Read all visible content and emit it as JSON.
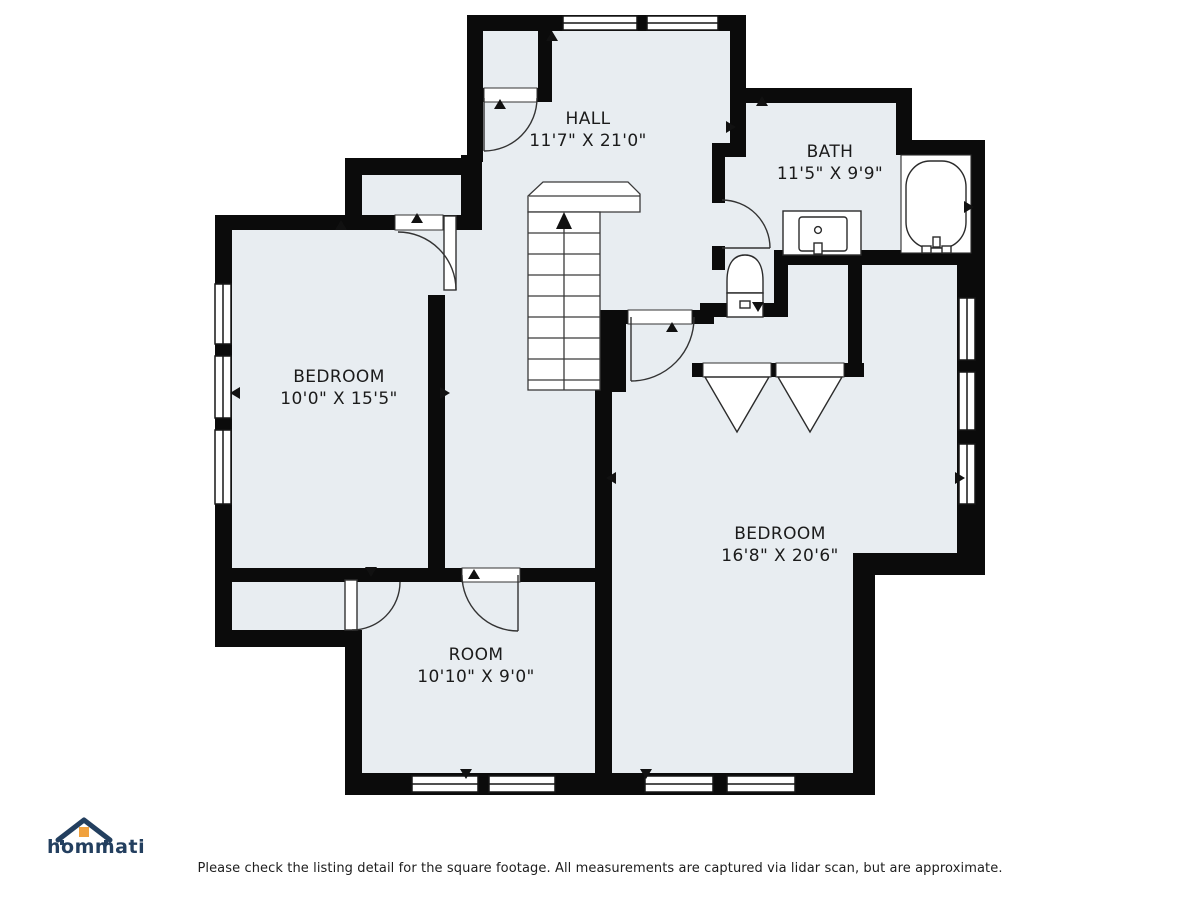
{
  "plan": {
    "colors": {
      "wall": "#0b0b0b",
      "floor": "#e8edf1",
      "fixture_stroke": "#2b2b2b"
    },
    "rooms": [
      {
        "name": "HALL",
        "dims": "11'7\" X 21'0\""
      },
      {
        "name": "BATH",
        "dims": "11'5\" X 9'9\""
      },
      {
        "name": "BEDROOM",
        "dims": "10'0\" X 15'5\""
      },
      {
        "name": "BEDROOM",
        "dims": "16'8\" X 20'6\""
      },
      {
        "name": "ROOM",
        "dims": "10'10\" X 9'0\""
      }
    ],
    "fixtures": [
      "staircase",
      "bathtub",
      "vanity-sink",
      "toilet",
      "bifold-closet-doors",
      "hinged-doors",
      "windows"
    ]
  },
  "footer": {
    "logo_text": "hommati",
    "disclaimer": "Please check the listing detail for the square footage. All measurements are captured via lidar scan, but are approximate."
  }
}
